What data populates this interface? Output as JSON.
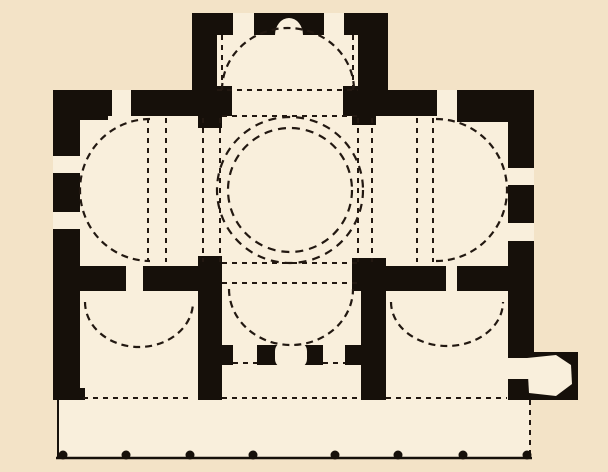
{
  "figure": {
    "kind": "architectural-floor-plan",
    "subject": "domed cross-in-square church plan with south portico",
    "canvas": {
      "width": 608,
      "height": 472
    },
    "colors": {
      "background": "#f3e3c7",
      "interior": "#f9efdc",
      "ink": "#16100a",
      "dash": "#221811"
    }
  },
  "plan": {
    "interior_regions": [
      {
        "name": "apse-room-floor",
        "x": 217,
        "y": 35,
        "w": 141,
        "h": 81
      },
      {
        "name": "naos-floor",
        "x": 80,
        "y": 116,
        "w": 428,
        "h": 150
      },
      {
        "name": "south-arm-floor",
        "x": 222,
        "y": 266,
        "w": 139,
        "h": 79
      },
      {
        "name": "south-rooms-floor",
        "x": 80,
        "y": 291,
        "w": 428,
        "h": 109
      },
      {
        "name": "porch-floor",
        "x": 58,
        "y": 400,
        "w": 472,
        "h": 58
      }
    ],
    "walls": [
      {
        "name": "apse-wall-left",
        "x": 192,
        "y": 13,
        "w": 25,
        "h": 103
      },
      {
        "name": "apse-wall-right",
        "x": 358,
        "y": 13,
        "w": 30,
        "h": 103
      },
      {
        "name": "apse-wall-top",
        "x": 192,
        "y": 13,
        "w": 196,
        "h": 22
      },
      {
        "name": "north-wall-west",
        "x": 53,
        "y": 90,
        "w": 139,
        "h": 26
      },
      {
        "name": "north-wall-east",
        "x": 388,
        "y": 90,
        "w": 143,
        "h": 26
      },
      {
        "name": "nw-corner-block",
        "x": 80,
        "y": 90,
        "w": 28,
        "h": 30
      },
      {
        "name": "ne-corner-block",
        "x": 457,
        "y": 90,
        "w": 51,
        "h": 32
      },
      {
        "name": "west-wall",
        "x": 53,
        "y": 90,
        "w": 27,
        "h": 310
      },
      {
        "name": "east-wall",
        "x": 508,
        "y": 90,
        "w": 26,
        "h": 310
      },
      {
        "name": "nw-crossing-pier",
        "x": 198,
        "y": 116,
        "w": 24,
        "h": 12
      },
      {
        "name": "ne-crossing-pier",
        "x": 352,
        "y": 116,
        "w": 24,
        "h": 9
      },
      {
        "name": "apse-mouth-stub-west",
        "x": 217,
        "y": 86,
        "w": 15,
        "h": 30
      },
      {
        "name": "apse-mouth-stub-east",
        "x": 343,
        "y": 86,
        "w": 15,
        "h": 30
      },
      {
        "name": "sw-crossing-pier",
        "x": 198,
        "y": 256,
        "w": 24,
        "h": 12
      },
      {
        "name": "se-crossing-pier",
        "x": 352,
        "y": 258,
        "w": 34,
        "h": 33
      },
      {
        "name": "naos-south-wall-a",
        "x": 53,
        "y": 266,
        "w": 73,
        "h": 25
      },
      {
        "name": "naos-south-wall-b",
        "x": 143,
        "y": 266,
        "w": 79,
        "h": 25
      },
      {
        "name": "naos-south-wall-c",
        "x": 386,
        "y": 266,
        "w": 60,
        "h": 25
      },
      {
        "name": "naos-south-wall-d",
        "x": 457,
        "y": 266,
        "w": 51,
        "h": 25
      },
      {
        "name": "sw-room-east-wall",
        "x": 198,
        "y": 291,
        "w": 24,
        "h": 109
      },
      {
        "name": "se-room-west-wall",
        "x": 361,
        "y": 291,
        "w": 25,
        "h": 109
      },
      {
        "name": "south-entrance-wall",
        "x": 222,
        "y": 345,
        "w": 139,
        "h": 20
      },
      {
        "name": "south-wall-foot-left",
        "x": 53,
        "y": 388,
        "w": 32,
        "h": 12
      },
      {
        "name": "annex-body",
        "x": 530,
        "y": 352,
        "w": 48,
        "h": 48
      }
    ],
    "openings": [
      {
        "name": "window-north-west",
        "x": 112,
        "y": 90,
        "w": 19,
        "h": 26
      },
      {
        "name": "window-north-east",
        "x": 437,
        "y": 90,
        "w": 20,
        "h": 26
      },
      {
        "name": "window-apse-left",
        "x": 233,
        "y": 13,
        "w": 21,
        "h": 22
      },
      {
        "name": "window-apse-right",
        "x": 324,
        "y": 13,
        "w": 20,
        "h": 22
      },
      {
        "name": "window-west-1",
        "x": 53,
        "y": 156,
        "w": 27,
        "h": 17
      },
      {
        "name": "window-west-2",
        "x": 53,
        "y": 212,
        "w": 27,
        "h": 17
      },
      {
        "name": "window-east-1",
        "x": 508,
        "y": 168,
        "w": 26,
        "h": 17
      },
      {
        "name": "window-east-2",
        "x": 508,
        "y": 223,
        "w": 26,
        "h": 18
      },
      {
        "name": "door-naos-to-sw",
        "x": 126,
        "y": 266,
        "w": 17,
        "h": 25
      },
      {
        "name": "door-naos-to-se",
        "x": 446,
        "y": 266,
        "w": 11,
        "h": 25
      },
      {
        "name": "door-south-left",
        "x": 233,
        "y": 345,
        "w": 24,
        "h": 20
      },
      {
        "name": "door-south-right",
        "x": 323,
        "y": 345,
        "w": 22,
        "h": 20
      },
      {
        "name": "door-annex",
        "x": 508,
        "y": 358,
        "w": 22,
        "h": 21
      }
    ],
    "rounded_features": [
      {
        "name": "south-portal-base",
        "x": 275,
        "y": 342,
        "w": 32,
        "h": 26,
        "rx": 9
      }
    ],
    "half_disc_niches": [
      {
        "name": "apse-niche",
        "cx": 289,
        "cy": 35,
        "rx": 14,
        "ry": 17,
        "half": "up"
      }
    ],
    "polygons": [
      {
        "name": "annex-chamber",
        "points": "527,358 556,355 571,365 572,384 556,396 529,393"
      }
    ],
    "dashed_circles": [
      {
        "name": "dome-ring-outer",
        "cx": 290,
        "cy": 190,
        "r": 73
      },
      {
        "name": "dome-ring-inner",
        "cx": 290,
        "cy": 190,
        "r": 62
      }
    ],
    "dashed_arcs": [
      {
        "name": "apse-conch",
        "cx": 288,
        "cy": 90,
        "rx": 66,
        "ry": 62,
        "half": "up"
      },
      {
        "name": "west-conch",
        "cx": 150,
        "cy": 190,
        "rx": 70,
        "ry": 71,
        "half": "left"
      },
      {
        "name": "east-conch",
        "cx": 436,
        "cy": 190,
        "rx": 71,
        "ry": 71,
        "half": "right"
      },
      {
        "name": "south-conch",
        "cx": 291,
        "cy": 289,
        "rx": 62,
        "ry": 56,
        "half": "down"
      },
      {
        "name": "sw-lunette",
        "cx": 139,
        "cy": 302,
        "rx": 54,
        "ry": 45,
        "half": "down"
      },
      {
        "name": "se-lunette",
        "cx": 447,
        "cy": 302,
        "rx": 56,
        "ry": 44,
        "half": "down"
      }
    ],
    "dashed_lines": [
      {
        "name": "apse-chord",
        "x1": 217,
        "y1": 90,
        "x2": 358,
        "y2": 90
      },
      {
        "name": "crossing-north-edge",
        "x1": 222,
        "y1": 116,
        "x2": 358,
        "y2": 116
      },
      {
        "name": "crossing-south-edge",
        "x1": 222,
        "y1": 263,
        "x2": 358,
        "y2": 263
      },
      {
        "name": "south-arm-edge",
        "x1": 222,
        "y1": 283,
        "x2": 358,
        "y2": 283
      },
      {
        "name": "apse-jamb-west",
        "x1": 222,
        "y1": 35,
        "x2": 222,
        "y2": 90
      },
      {
        "name": "apse-jamb-east",
        "x1": 353,
        "y1": 35,
        "x2": 353,
        "y2": 90
      },
      {
        "name": "west-vault-line-1",
        "x1": 148,
        "y1": 118,
        "x2": 148,
        "y2": 262
      },
      {
        "name": "west-vault-line-2",
        "x1": 166,
        "y1": 118,
        "x2": 166,
        "y2": 262
      },
      {
        "name": "west-vault-line-3",
        "x1": 203,
        "y1": 118,
        "x2": 203,
        "y2": 262
      },
      {
        "name": "crossing-west-edge",
        "x1": 220,
        "y1": 118,
        "x2": 220,
        "y2": 262
      },
      {
        "name": "crossing-east-edge",
        "x1": 358,
        "y1": 118,
        "x2": 358,
        "y2": 262
      },
      {
        "name": "east-vault-line-1",
        "x1": 372,
        "y1": 118,
        "x2": 372,
        "y2": 262
      },
      {
        "name": "east-vault-line-2",
        "x1": 417,
        "y1": 118,
        "x2": 417,
        "y2": 262
      },
      {
        "name": "east-vault-line-3",
        "x1": 433,
        "y1": 118,
        "x2": 433,
        "y2": 262
      },
      {
        "name": "sill-sw-room",
        "x1": 83,
        "y1": 398,
        "x2": 193,
        "y2": 398
      },
      {
        "name": "sill-center-bay",
        "x1": 222,
        "y1": 398,
        "x2": 361,
        "y2": 398
      },
      {
        "name": "sill-se-room",
        "x1": 386,
        "y1": 398,
        "x2": 507,
        "y2": 398
      },
      {
        "name": "door-sill-left",
        "x1": 233,
        "y1": 363,
        "x2": 257,
        "y2": 363
      },
      {
        "name": "door-sill-right",
        "x1": 323,
        "y1": 363,
        "x2": 345,
        "y2": 363
      },
      {
        "name": "porch-east-edge",
        "x1": 530,
        "y1": 400,
        "x2": 530,
        "y2": 458
      }
    ],
    "solid_lines": [
      {
        "name": "porch-west-edge",
        "x1": 58,
        "y1": 400,
        "x2": 58,
        "y2": 459,
        "w": 2
      },
      {
        "name": "stylobate-line",
        "x1": 56,
        "y1": 458,
        "x2": 532,
        "y2": 458,
        "w": 2.5
      }
    ],
    "colonnade": {
      "name": "porch-column-bases",
      "cy": 455,
      "r": 4.5,
      "xs": [
        63,
        126,
        190,
        253,
        335,
        398,
        463,
        527
      ]
    }
  }
}
